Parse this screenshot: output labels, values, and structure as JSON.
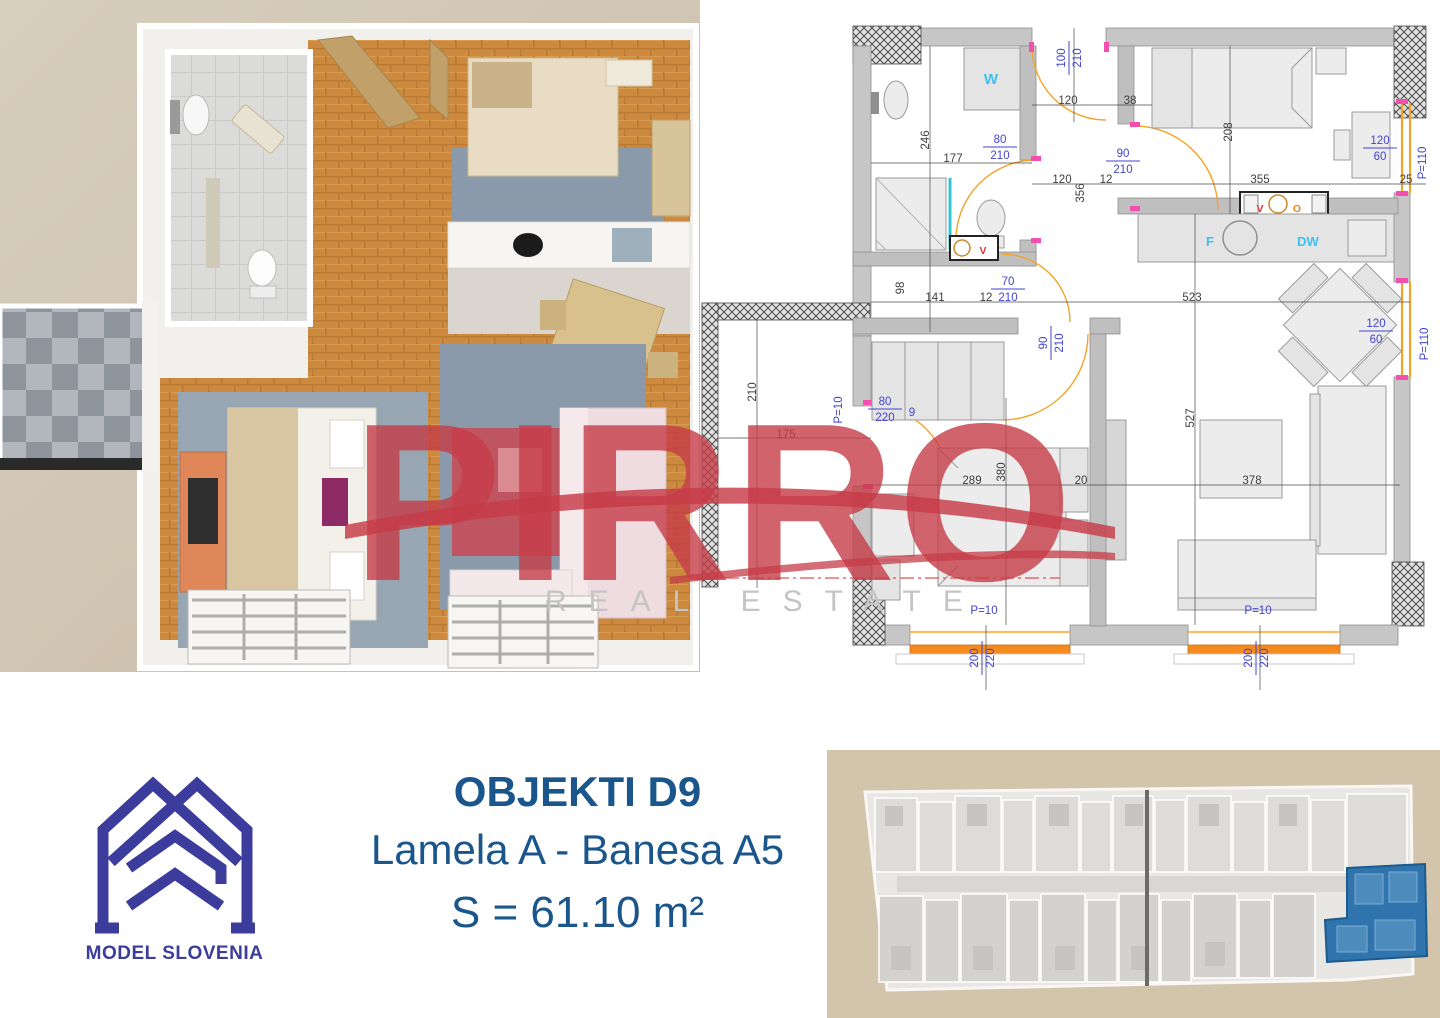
{
  "watermark": {
    "word": "PIRRO",
    "tagline": "REAL ESTATE",
    "word_color": "#c63c48",
    "tagline_color": "#c4c4c4"
  },
  "logo": {
    "name": "MODEL SLOVENIA",
    "color": "#3c3c9c"
  },
  "caption": {
    "line1": "OBJEKTI D9",
    "line2": "Lamela A - Banesa A5",
    "line3": "S = 61.10 m²",
    "color": "#1a568c"
  },
  "plan2d": {
    "dim_color_black": "#3f3f3f",
    "dim_color_blue": "#4343cf",
    "label_color_cyan": "#3fc0f0",
    "dims": [
      {
        "t": "100/210",
        "x": 368,
        "y": 58,
        "r": -90,
        "c": "b",
        "f": 1
      },
      {
        "t": "120",
        "x": 368,
        "y": 100
      },
      {
        "t": "38",
        "x": 430,
        "y": 100
      },
      {
        "t": "208",
        "x": 528,
        "y": 132,
        "r": -90
      },
      {
        "t": "246",
        "x": 225,
        "y": 140,
        "r": -90
      },
      {
        "t": "177",
        "x": 253,
        "y": 158
      },
      {
        "t": "80/210",
        "x": 300,
        "y": 146,
        "c": "b",
        "f": 1
      },
      {
        "t": "90/210",
        "x": 423,
        "y": 160,
        "c": "b",
        "f": 1
      },
      {
        "t": "120",
        "x": 362,
        "y": 179
      },
      {
        "t": "356",
        "x": 380,
        "y": 193,
        "r": -90
      },
      {
        "t": "12",
        "x": 406,
        "y": 179
      },
      {
        "t": "355",
        "x": 560,
        "y": 179
      },
      {
        "t": "25",
        "x": 706,
        "y": 179
      },
      {
        "t": "120/60",
        "x": 680,
        "y": 147,
        "c": "b",
        "f": 1
      },
      {
        "t": "P=110",
        "x": 722,
        "y": 163,
        "r": -90,
        "c": "b"
      },
      {
        "t": "98",
        "x": 200,
        "y": 288,
        "r": -90
      },
      {
        "t": "141",
        "x": 235,
        "y": 297
      },
      {
        "t": "12",
        "x": 286,
        "y": 297
      },
      {
        "t": "70/210",
        "x": 308,
        "y": 288,
        "c": "b",
        "f": 1
      },
      {
        "t": "523",
        "x": 492,
        "y": 297
      },
      {
        "t": "90/210",
        "x": 350,
        "y": 343,
        "r": -90,
        "c": "b",
        "f": 1
      },
      {
        "t": "120/60",
        "x": 676,
        "y": 330,
        "c": "b",
        "f": 1
      },
      {
        "t": "P=110",
        "x": 724,
        "y": 344,
        "r": -90,
        "c": "b"
      },
      {
        "t": "210",
        "x": 52,
        "y": 392,
        "r": -90
      },
      {
        "t": "175",
        "x": 86,
        "y": 434
      },
      {
        "t": "P=10",
        "x": 138,
        "y": 410,
        "r": -90,
        "c": "b"
      },
      {
        "t": "80/220",
        "x": 185,
        "y": 408,
        "c": "b",
        "f": 1
      },
      {
        "t": "9",
        "x": 212,
        "y": 412,
        "c": "b"
      },
      {
        "t": "289",
        "x": 272,
        "y": 480
      },
      {
        "t": "380",
        "x": 301,
        "y": 472,
        "r": -90
      },
      {
        "t": "20",
        "x": 381,
        "y": 480
      },
      {
        "t": "378",
        "x": 552,
        "y": 480
      },
      {
        "t": "527",
        "x": 490,
        "y": 418,
        "r": -90
      },
      {
        "t": "P=10",
        "x": 284,
        "y": 610,
        "c": "b"
      },
      {
        "t": "200/220",
        "x": 281,
        "y": 658,
        "r": -90,
        "c": "b",
        "f": 1
      },
      {
        "t": "P=10",
        "x": 558,
        "y": 610,
        "c": "b"
      },
      {
        "t": "200/220",
        "x": 555,
        "y": 658,
        "r": -90,
        "c": "b",
        "f": 1
      },
      {
        "t": "W",
        "x": 291,
        "y": 80,
        "c": "c"
      },
      {
        "t": "F",
        "x": 510,
        "y": 242,
        "c": "c2"
      },
      {
        "t": "DW",
        "x": 608,
        "y": 242,
        "c": "c2"
      },
      {
        "t": "V",
        "x": 283,
        "y": 250,
        "c": "r"
      },
      {
        "t": "V",
        "x": 560,
        "y": 208,
        "c": "r"
      },
      {
        "t": "O",
        "x": 597,
        "y": 208,
        "c": "o"
      }
    ]
  },
  "building_overview": {
    "background": "#d2c5ab",
    "body_color": "#e9e7e3",
    "highlight": "#2f74ad"
  }
}
